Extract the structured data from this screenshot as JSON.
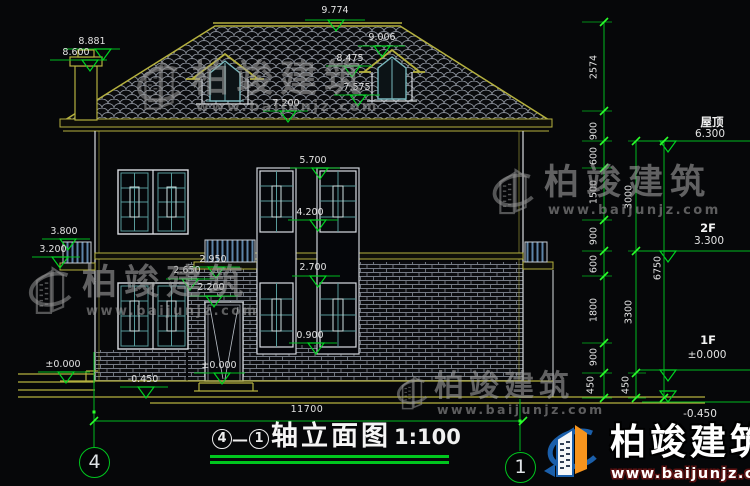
{
  "watermark": {
    "brand": "柏竣建筑",
    "url": "www.baijunjz.com"
  },
  "title": {
    "bubble_left": "4",
    "dash": "—",
    "bubble_right": "1",
    "text": "轴立面图",
    "scale": "1:100"
  },
  "axis_bubbles": {
    "left": "4",
    "right": "1"
  },
  "levels": {
    "roof_label": "屋顶",
    "roof_value": "6.300",
    "f2_label": "2F",
    "f2_value": "3.300",
    "f1_label": "1F",
    "f1_value": "±0.000",
    "grade_right": "-0.450"
  },
  "marks": {
    "ridge": "9.774",
    "chimney_top": "8.881",
    "chimney_cap": "8.600",
    "dormer_r_top": "9.006",
    "dormer_r_eave": "8.475",
    "dormer_r_base": "7.575",
    "eave": "7.200",
    "w2_top": "5.700",
    "w2_bottom": "4.200",
    "left_balcony_top": "3.800",
    "left_balcony_bottom": "3.200",
    "railing_top": "2.950",
    "balcony_slab": "2.650",
    "w1_top": "2.700",
    "door_top": "2.200",
    "w1_sill": "0.900",
    "door_zero": "±0.000",
    "ground_left": "±0.000",
    "grade_left": "-0.450"
  },
  "dims": {
    "chain1": [
      "2574",
      "900",
      "600",
      "1500",
      "900",
      "600",
      "1800",
      "900",
      "450"
    ],
    "chain2": [
      "3000",
      "3300",
      "450"
    ],
    "chain3": [
      "6750"
    ],
    "overall_width": "11700"
  }
}
